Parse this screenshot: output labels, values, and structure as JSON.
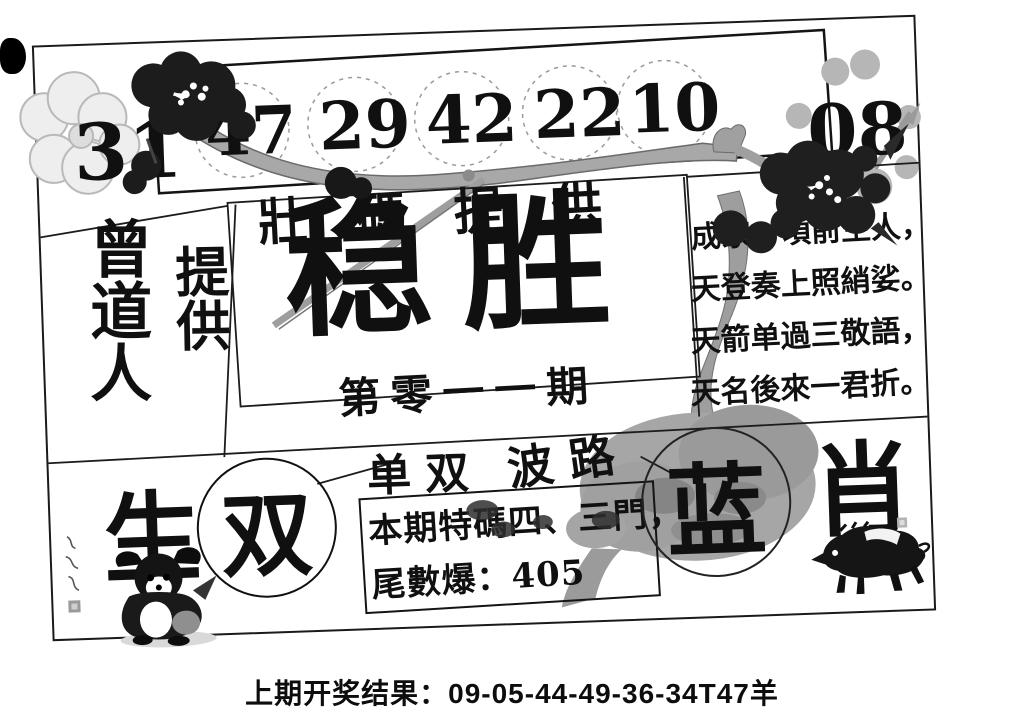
{
  "panel": {
    "provider_title": "壯碼提供",
    "numbers": [
      "31",
      "47",
      "29",
      "42",
      "22",
      "10",
      "08"
    ],
    "left_column": {
      "provider": "曾道人",
      "provides": "提供"
    },
    "center": {
      "title": "稳胜",
      "issue": "第零一一期"
    },
    "poem": {
      "lines": [
        "成家一頃前生人，",
        "天登奏上照綃娑。",
        "天箭单過三敬語，",
        "天名後來一君折。"
      ]
    },
    "bottom": {
      "zodiac_left": "生",
      "zodiac_right": "肖",
      "parity_header": "单双",
      "wave_header": "波路",
      "parity_pick": "双",
      "color_pick": "蓝",
      "special_box_line1": "本期特碼四、三門，",
      "special_box_line2": "尾數爆：405"
    }
  },
  "footer": {
    "last_result": "上期开奖结果：09-05-44-49-36-34T47羊"
  },
  "colors": {
    "ink": "#111111",
    "branch_gray": "#a3a3a3",
    "paper": "#ffffff"
  }
}
